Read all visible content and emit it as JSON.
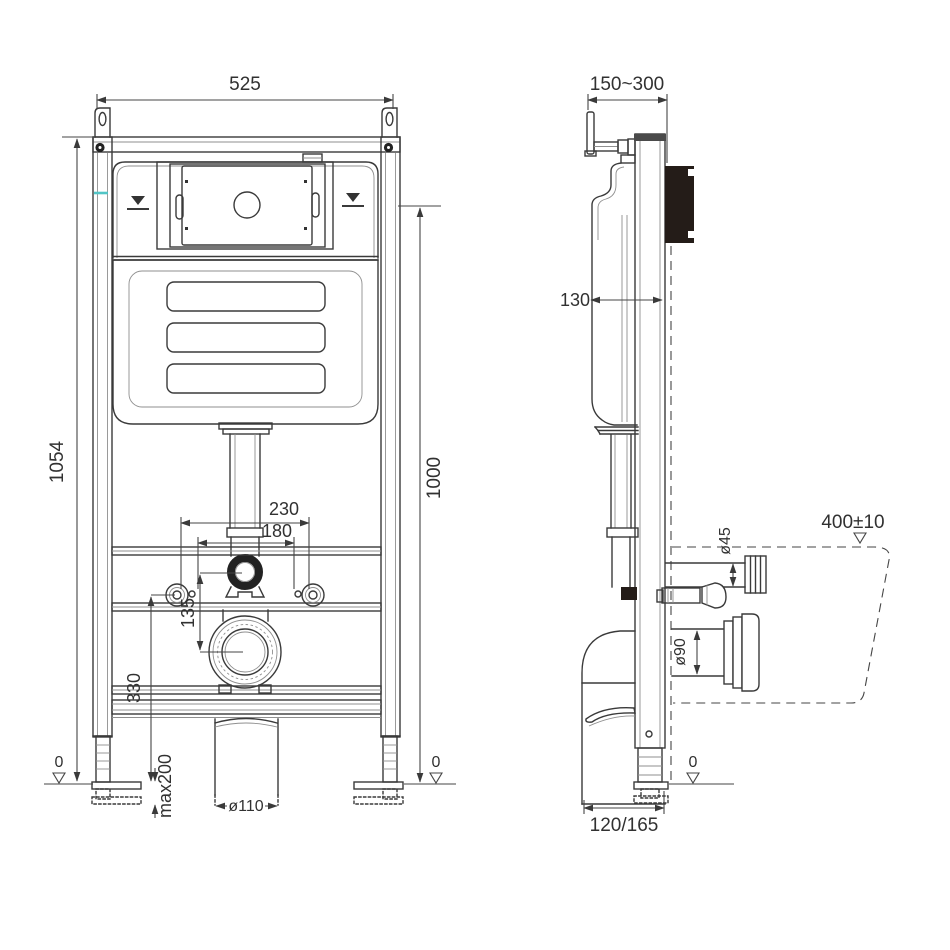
{
  "colors": {
    "line": "#3a3a3a",
    "accent_teal": "#52c5c6",
    "dark_fill": "#241c18"
  },
  "front_view": {
    "width": "525",
    "height_overall": "1054",
    "height_ref": "1000",
    "bolt_span_outer": "230",
    "bolt_span_inner": "180",
    "flush_outlet_offset": "135",
    "outlet_height": "330",
    "foot_adjust": "max200",
    "drain_dia": "ø110",
    "floor_left": "0",
    "floor_right": "0"
  },
  "side_view": {
    "depth_range": "150~300",
    "cistern_depth": "130",
    "rim_height": "400±10",
    "flush_dia": "ø45",
    "outlet_dia": "ø90",
    "outlet_depth": "120/165",
    "floor": "0"
  }
}
